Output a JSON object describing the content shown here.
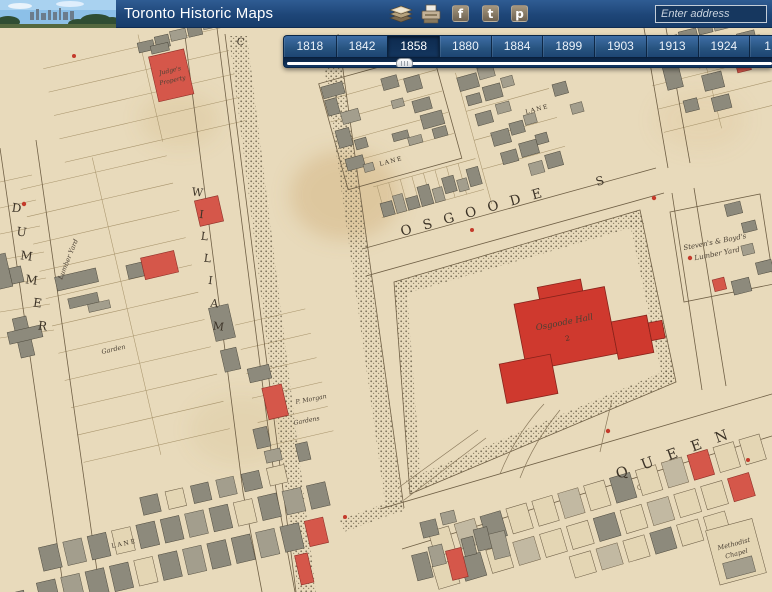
{
  "header": {
    "title": "Toronto Historic Maps",
    "icons": {
      "maps_icon": "book-stack",
      "print_icon": "printer",
      "facebook_glyph": "f",
      "twitter_glyph": "t",
      "pinterest_glyph": "p"
    },
    "search": {
      "placeholder": "Enter address"
    }
  },
  "timeline": {
    "years": [
      "1818",
      "1842",
      "1858",
      "1880",
      "1884",
      "1899",
      "1903",
      "1913",
      "1924"
    ],
    "next_year_partial": "1",
    "selected_year": "1858"
  },
  "map": {
    "streets": {
      "osgoode": "OSGOODE",
      "osgoode_suffix": "S",
      "queen": "QUEEN",
      "william": "WILLIAM",
      "dummer": "DUMMER",
      "college_initial": "C"
    },
    "labels": {
      "osgoode_hall": "Osgoode Hall",
      "osgoode_hall_no": "2",
      "stevens_line1": "Steven's & Boyd's",
      "stevens_line2": "Lumber Yard",
      "lumber_yard": "Lumber Yard",
      "garden": "Garden",
      "morgan_line1": "P. Morgan",
      "morgan_line2": "Gardens",
      "judges_line1": "Judge's",
      "judges_line2": "Property",
      "methodist_line1": "Methodist",
      "methodist_line2": "Chapel",
      "lane_a": "LANE",
      "lane_b": "LANE",
      "lane_c": "LANE"
    },
    "colors": {
      "paper": "#e8dabb",
      "building_grey": "#8d8a7c",
      "building_red": "#d5574a",
      "hall_red": "#cf392e",
      "ui_navy": "#1d4678"
    }
  }
}
